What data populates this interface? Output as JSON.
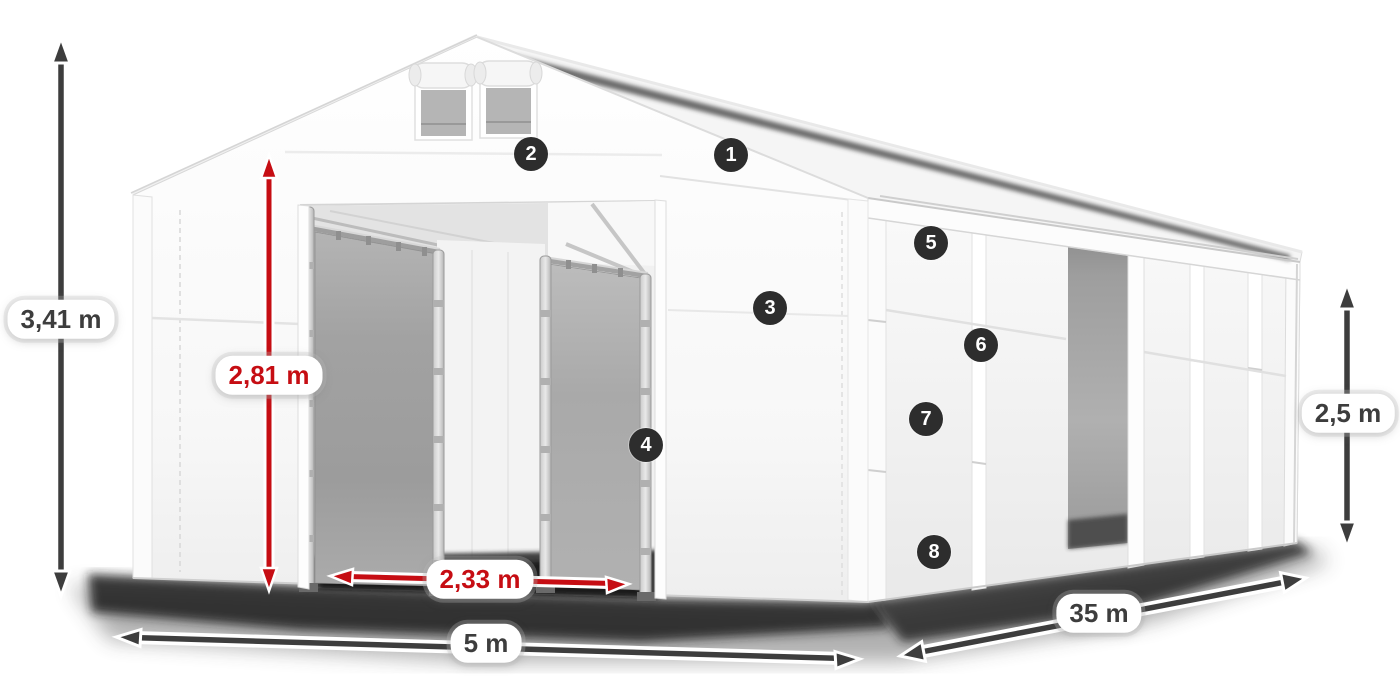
{
  "title": "Storage tent dimensions diagram",
  "canvas": {
    "width": 1400,
    "height": 700,
    "background": "#ffffff"
  },
  "colors": {
    "background": "#ffffff",
    "dimension_dark": "#3d3d3d",
    "dimension_red": "#c60d13",
    "label_bg": "#ffffff",
    "marker_bg": "#2d2d2d",
    "marker_fg": "#ffffff",
    "tent_white": "#f7f7f7",
    "door_gray": "#a0a0a0"
  },
  "dimensions": [
    {
      "id": "total-height",
      "text": "3,41 m",
      "style": "dark",
      "x": 61,
      "y": 319
    },
    {
      "id": "entrance-height",
      "text": "2,81 m",
      "style": "red",
      "x": 269,
      "y": 375
    },
    {
      "id": "entrance-width",
      "text": "2,33 m",
      "style": "red",
      "x": 480,
      "y": 579
    },
    {
      "id": "tent-width",
      "text": "5 m",
      "style": "dark",
      "x": 486,
      "y": 643
    },
    {
      "id": "tent-length",
      "text": "35 m",
      "style": "dark",
      "x": 1099,
      "y": 613
    },
    {
      "id": "side-height",
      "text": "2,5 m",
      "style": "dark",
      "x": 1348,
      "y": 413
    }
  ],
  "markers": [
    {
      "number": "1",
      "x": 731,
      "y": 155
    },
    {
      "number": "2",
      "x": 531,
      "y": 154
    },
    {
      "number": "3",
      "x": 770,
      "y": 308
    },
    {
      "number": "4",
      "x": 646,
      "y": 445
    },
    {
      "number": "5",
      "x": 931,
      "y": 243
    },
    {
      "number": "6",
      "x": 981,
      "y": 345
    },
    {
      "number": "7",
      "x": 926,
      "y": 419
    },
    {
      "number": "8",
      "x": 934,
      "y": 552
    }
  ]
}
